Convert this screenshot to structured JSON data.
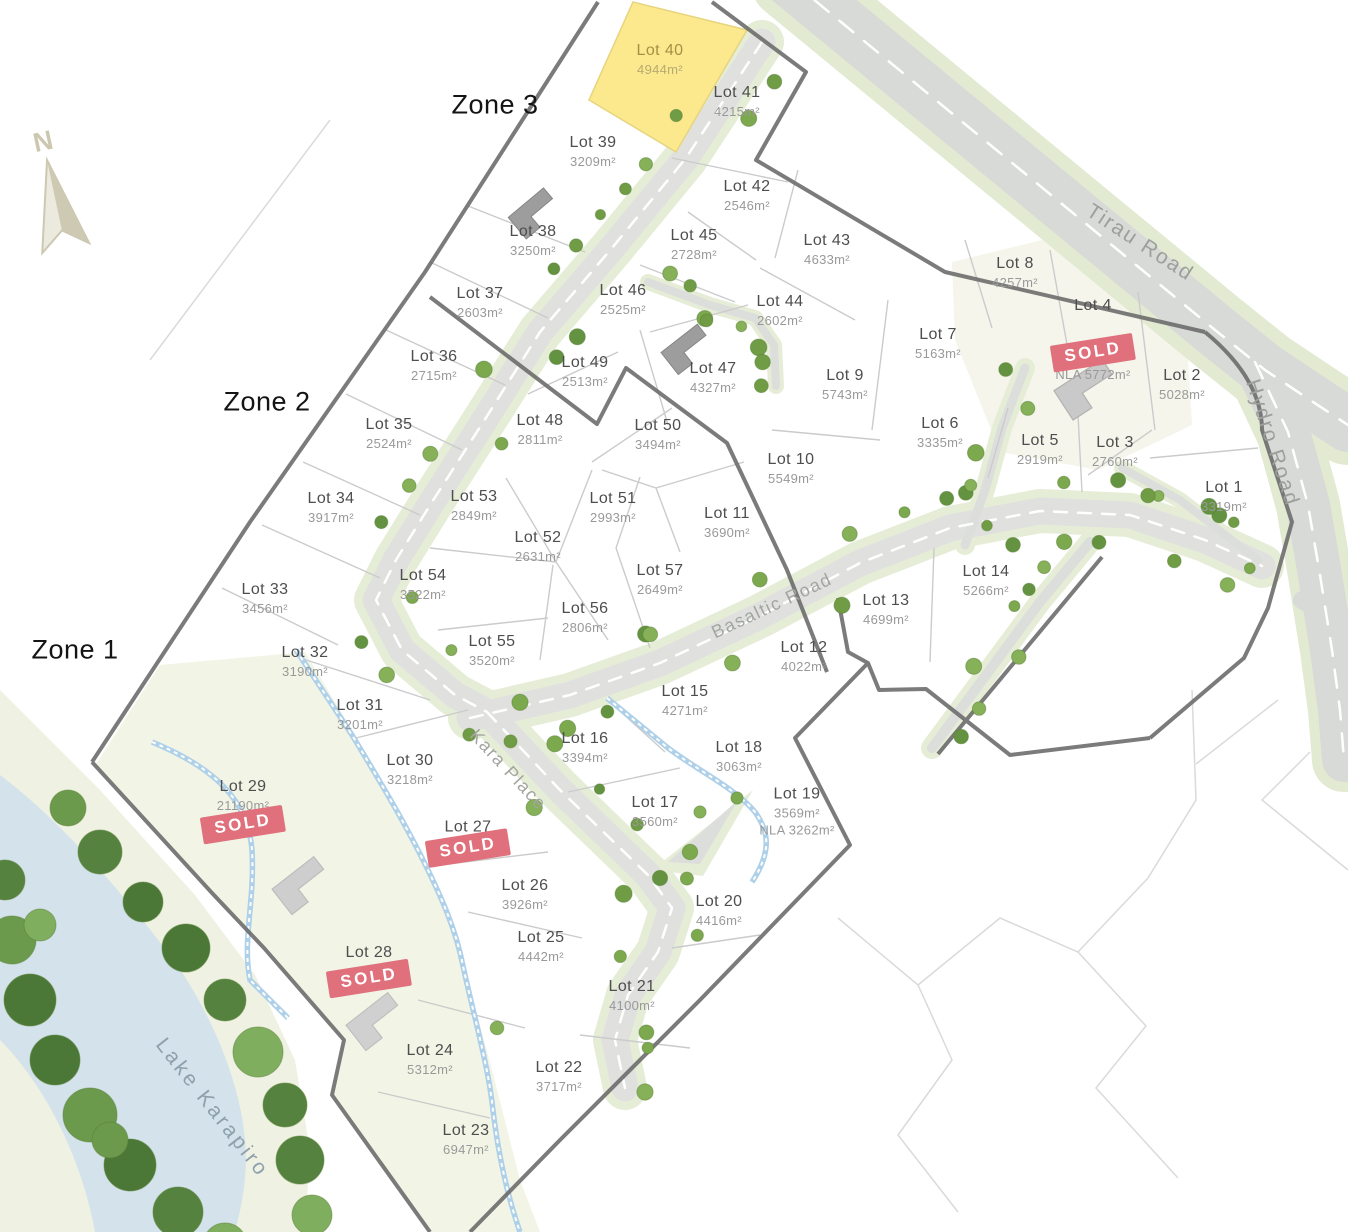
{
  "map": {
    "north_label": "N",
    "sold_label": "SOLD",
    "zones": [
      {
        "id": "1",
        "label": "Zone 1",
        "x": 75,
        "y": 650
      },
      {
        "id": "2",
        "label": "Zone 2",
        "x": 267,
        "y": 402
      },
      {
        "id": "3",
        "label": "Zone 3",
        "x": 495,
        "y": 105
      }
    ],
    "road_labels": [
      {
        "name": "tirau-road",
        "label": "Tirau Road",
        "x": 1140,
        "y": 243,
        "rot": 33
      },
      {
        "name": "hydro-road",
        "label": "Hydro Road",
        "x": 1272,
        "y": 443,
        "rot": 72
      },
      {
        "name": "basaltic-road",
        "label": "Basaltic Road",
        "x": 772,
        "y": 606,
        "rot": -25
      },
      {
        "name": "kara-place",
        "label": "Kara Place",
        "x": 508,
        "y": 770,
        "rot": 47
      }
    ],
    "water_label": {
      "label": "Lake Karapiro",
      "x": 212,
      "y": 1108,
      "rot": 52
    },
    "colors": {
      "highlight_lot": "#fce98e",
      "sold_badge": "#e0707b",
      "road": "#dedfdd",
      "verge": "#e5ecd6",
      "water": "#d3e2eb",
      "boundary": "#6d6d6d",
      "tree": "#6f9c44",
      "stream": "#aed0e8"
    }
  },
  "lots": [
    {
      "id": "1",
      "name": "Lot 1",
      "areas": [
        "3319m²"
      ],
      "x": 1224,
      "y": 497,
      "sold": false,
      "highlight": false
    },
    {
      "id": "2",
      "name": "Lot 2",
      "areas": [
        "5028m²"
      ],
      "x": 1182,
      "y": 385,
      "sold": false,
      "highlight": false
    },
    {
      "id": "3",
      "name": "Lot 3",
      "areas": [
        "2760m²"
      ],
      "x": 1115,
      "y": 452,
      "sold": false,
      "highlight": false
    },
    {
      "id": "4",
      "name": "Lot 4",
      "areas": [
        "NLA 5772m²"
      ],
      "x": 1093,
      "y": 340,
      "sold": true,
      "badge": "inline",
      "highlight": false
    },
    {
      "id": "5",
      "name": "Lot 5",
      "areas": [
        "2919m²"
      ],
      "x": 1040,
      "y": 450,
      "sold": false,
      "highlight": false
    },
    {
      "id": "6",
      "name": "Lot 6",
      "areas": [
        "3335m²"
      ],
      "x": 940,
      "y": 433,
      "sold": false,
      "highlight": false
    },
    {
      "id": "7",
      "name": "Lot 7",
      "areas": [
        "5163m²"
      ],
      "x": 938,
      "y": 344,
      "sold": false,
      "highlight": false
    },
    {
      "id": "8",
      "name": "Lot 8",
      "areas": [
        "4257m²"
      ],
      "x": 1015,
      "y": 273,
      "sold": false,
      "highlight": false
    },
    {
      "id": "9",
      "name": "Lot 9",
      "areas": [
        "5743m²"
      ],
      "x": 845,
      "y": 385,
      "sold": false,
      "highlight": false
    },
    {
      "id": "10",
      "name": "Lot 10",
      "areas": [
        "5549m²"
      ],
      "x": 791,
      "y": 469,
      "sold": false,
      "highlight": false
    },
    {
      "id": "11",
      "name": "Lot 11",
      "areas": [
        "3690m²"
      ],
      "x": 727,
      "y": 523,
      "sold": false,
      "highlight": false
    },
    {
      "id": "12",
      "name": "Lot 12",
      "areas": [
        "4022m²"
      ],
      "x": 804,
      "y": 657,
      "sold": false,
      "highlight": false
    },
    {
      "id": "13",
      "name": "Lot 13",
      "areas": [
        "4699m²"
      ],
      "x": 886,
      "y": 610,
      "sold": false,
      "highlight": false
    },
    {
      "id": "14",
      "name": "Lot 14",
      "areas": [
        "5266m²"
      ],
      "x": 986,
      "y": 581,
      "sold": false,
      "highlight": false
    },
    {
      "id": "15",
      "name": "Lot 15",
      "areas": [
        "4271m²"
      ],
      "x": 685,
      "y": 701,
      "sold": false,
      "highlight": false
    },
    {
      "id": "16",
      "name": "Lot 16",
      "areas": [
        "3394m²"
      ],
      "x": 585,
      "y": 748,
      "sold": false,
      "highlight": false
    },
    {
      "id": "17",
      "name": "Lot 17",
      "areas": [
        "3560m²"
      ],
      "x": 655,
      "y": 812,
      "sold": false,
      "highlight": false
    },
    {
      "id": "18",
      "name": "Lot 18",
      "areas": [
        "3063m²"
      ],
      "x": 739,
      "y": 757,
      "sold": false,
      "highlight": false
    },
    {
      "id": "19",
      "name": "Lot 19",
      "areas": [
        "3569m²",
        "NLA 3262m²"
      ],
      "x": 797,
      "y": 812,
      "sold": false,
      "highlight": false
    },
    {
      "id": "20",
      "name": "Lot 20",
      "areas": [
        "4416m²"
      ],
      "x": 719,
      "y": 911,
      "sold": false,
      "highlight": false
    },
    {
      "id": "21",
      "name": "Lot 21",
      "areas": [
        "4100m²"
      ],
      "x": 632,
      "y": 996,
      "sold": false,
      "highlight": false
    },
    {
      "id": "22",
      "name": "Lot 22",
      "areas": [
        "3717m²"
      ],
      "x": 559,
      "y": 1077,
      "sold": false,
      "highlight": false
    },
    {
      "id": "23",
      "name": "Lot 23",
      "areas": [
        "6947m²"
      ],
      "x": 466,
      "y": 1140,
      "sold": false,
      "highlight": false
    },
    {
      "id": "24",
      "name": "Lot 24",
      "areas": [
        "5312m²"
      ],
      "x": 430,
      "y": 1060,
      "sold": false,
      "highlight": false
    },
    {
      "id": "25",
      "name": "Lot 25",
      "areas": [
        "4442m²"
      ],
      "x": 541,
      "y": 947,
      "sold": false,
      "highlight": false
    },
    {
      "id": "26",
      "name": "Lot 26",
      "areas": [
        "3926m²"
      ],
      "x": 525,
      "y": 895,
      "sold": false,
      "highlight": false
    },
    {
      "id": "27",
      "name": "Lot 27",
      "areas": [],
      "x": 468,
      "y": 840,
      "sold": true,
      "badge": "overlap",
      "highlight": false
    },
    {
      "id": "28",
      "name": "Lot 28",
      "areas": [],
      "x": 369,
      "y": 968,
      "sold": true,
      "badge": "below",
      "highlight": false
    },
    {
      "id": "29",
      "name": "Lot 29",
      "areas": [
        "21190m²"
      ],
      "x": 243,
      "y": 808,
      "sold": true,
      "badge": "overlap",
      "highlight": false
    },
    {
      "id": "30",
      "name": "Lot 30",
      "areas": [
        "3218m²"
      ],
      "x": 410,
      "y": 770,
      "sold": false,
      "highlight": false
    },
    {
      "id": "31",
      "name": "Lot 31",
      "areas": [
        "3201m²"
      ],
      "x": 360,
      "y": 715,
      "sold": false,
      "highlight": false
    },
    {
      "id": "32",
      "name": "Lot 32",
      "areas": [
        "3190m²"
      ],
      "x": 305,
      "y": 662,
      "sold": false,
      "highlight": false
    },
    {
      "id": "33",
      "name": "Lot 33",
      "areas": [
        "3456m²"
      ],
      "x": 265,
      "y": 599,
      "sold": false,
      "highlight": false
    },
    {
      "id": "34",
      "name": "Lot 34",
      "areas": [
        "3917m²"
      ],
      "x": 331,
      "y": 508,
      "sold": false,
      "highlight": false
    },
    {
      "id": "35",
      "name": "Lot 35",
      "areas": [
        "2524m²"
      ],
      "x": 389,
      "y": 434,
      "sold": false,
      "highlight": false
    },
    {
      "id": "36",
      "name": "Lot 36",
      "areas": [
        "2715m²"
      ],
      "x": 434,
      "y": 366,
      "sold": false,
      "highlight": false
    },
    {
      "id": "37",
      "name": "Lot 37",
      "areas": [
        "2603m²"
      ],
      "x": 480,
      "y": 303,
      "sold": false,
      "highlight": false
    },
    {
      "id": "38",
      "name": "Lot 38",
      "areas": [
        "3250m²"
      ],
      "x": 533,
      "y": 241,
      "sold": false,
      "highlight": false
    },
    {
      "id": "39",
      "name": "Lot 39",
      "areas": [
        "3209m²"
      ],
      "x": 593,
      "y": 152,
      "sold": false,
      "highlight": false
    },
    {
      "id": "40",
      "name": "Lot 40",
      "areas": [
        "4944m²"
      ],
      "x": 660,
      "y": 60,
      "sold": false,
      "highlight": true
    },
    {
      "id": "41",
      "name": "Lot 41",
      "areas": [
        "4215m²"
      ],
      "x": 737,
      "y": 102,
      "sold": false,
      "highlight": false
    },
    {
      "id": "42",
      "name": "Lot 42",
      "areas": [
        "2546m²"
      ],
      "x": 747,
      "y": 196,
      "sold": false,
      "highlight": false
    },
    {
      "id": "43",
      "name": "Lot 43",
      "areas": [
        "4633m²"
      ],
      "x": 827,
      "y": 250,
      "sold": false,
      "highlight": false
    },
    {
      "id": "44",
      "name": "Lot 44",
      "areas": [
        "2602m²"
      ],
      "x": 780,
      "y": 311,
      "sold": false,
      "highlight": false
    },
    {
      "id": "45",
      "name": "Lot 45",
      "areas": [
        "2728m²"
      ],
      "x": 694,
      "y": 245,
      "sold": false,
      "highlight": false
    },
    {
      "id": "46",
      "name": "Lot 46",
      "areas": [
        "2525m²"
      ],
      "x": 623,
      "y": 300,
      "sold": false,
      "highlight": false
    },
    {
      "id": "47",
      "name": "Lot 47",
      "areas": [
        "4327m²"
      ],
      "x": 713,
      "y": 378,
      "sold": false,
      "highlight": false
    },
    {
      "id": "48",
      "name": "Lot 48",
      "areas": [
        "2811m²"
      ],
      "x": 540,
      "y": 430,
      "sold": false,
      "highlight": false
    },
    {
      "id": "49",
      "name": "Lot 49",
      "areas": [
        "2513m²"
      ],
      "x": 585,
      "y": 372,
      "sold": false,
      "highlight": false
    },
    {
      "id": "50",
      "name": "Lot 50",
      "areas": [
        "3494m²"
      ],
      "x": 658,
      "y": 435,
      "sold": false,
      "highlight": false
    },
    {
      "id": "51",
      "name": "Lot 51",
      "areas": [
        "2993m²"
      ],
      "x": 613,
      "y": 508,
      "sold": false,
      "highlight": false
    },
    {
      "id": "52",
      "name": "Lot 52",
      "areas": [
        "2631m²"
      ],
      "x": 538,
      "y": 547,
      "sold": false,
      "highlight": false
    },
    {
      "id": "53",
      "name": "Lot 53",
      "areas": [
        "2849m²"
      ],
      "x": 474,
      "y": 506,
      "sold": false,
      "highlight": false
    },
    {
      "id": "54",
      "name": "Lot 54",
      "areas": [
        "3522m²"
      ],
      "x": 423,
      "y": 585,
      "sold": false,
      "highlight": false
    },
    {
      "id": "55",
      "name": "Lot 55",
      "areas": [
        "3520m²"
      ],
      "x": 492,
      "y": 651,
      "sold": false,
      "highlight": false
    },
    {
      "id": "56",
      "name": "Lot 56",
      "areas": [
        "2806m²"
      ],
      "x": 585,
      "y": 618,
      "sold": false,
      "highlight": false
    },
    {
      "id": "57",
      "name": "Lot 57",
      "areas": [
        "2649m²"
      ],
      "x": 660,
      "y": 580,
      "sold": false,
      "highlight": false
    }
  ]
}
